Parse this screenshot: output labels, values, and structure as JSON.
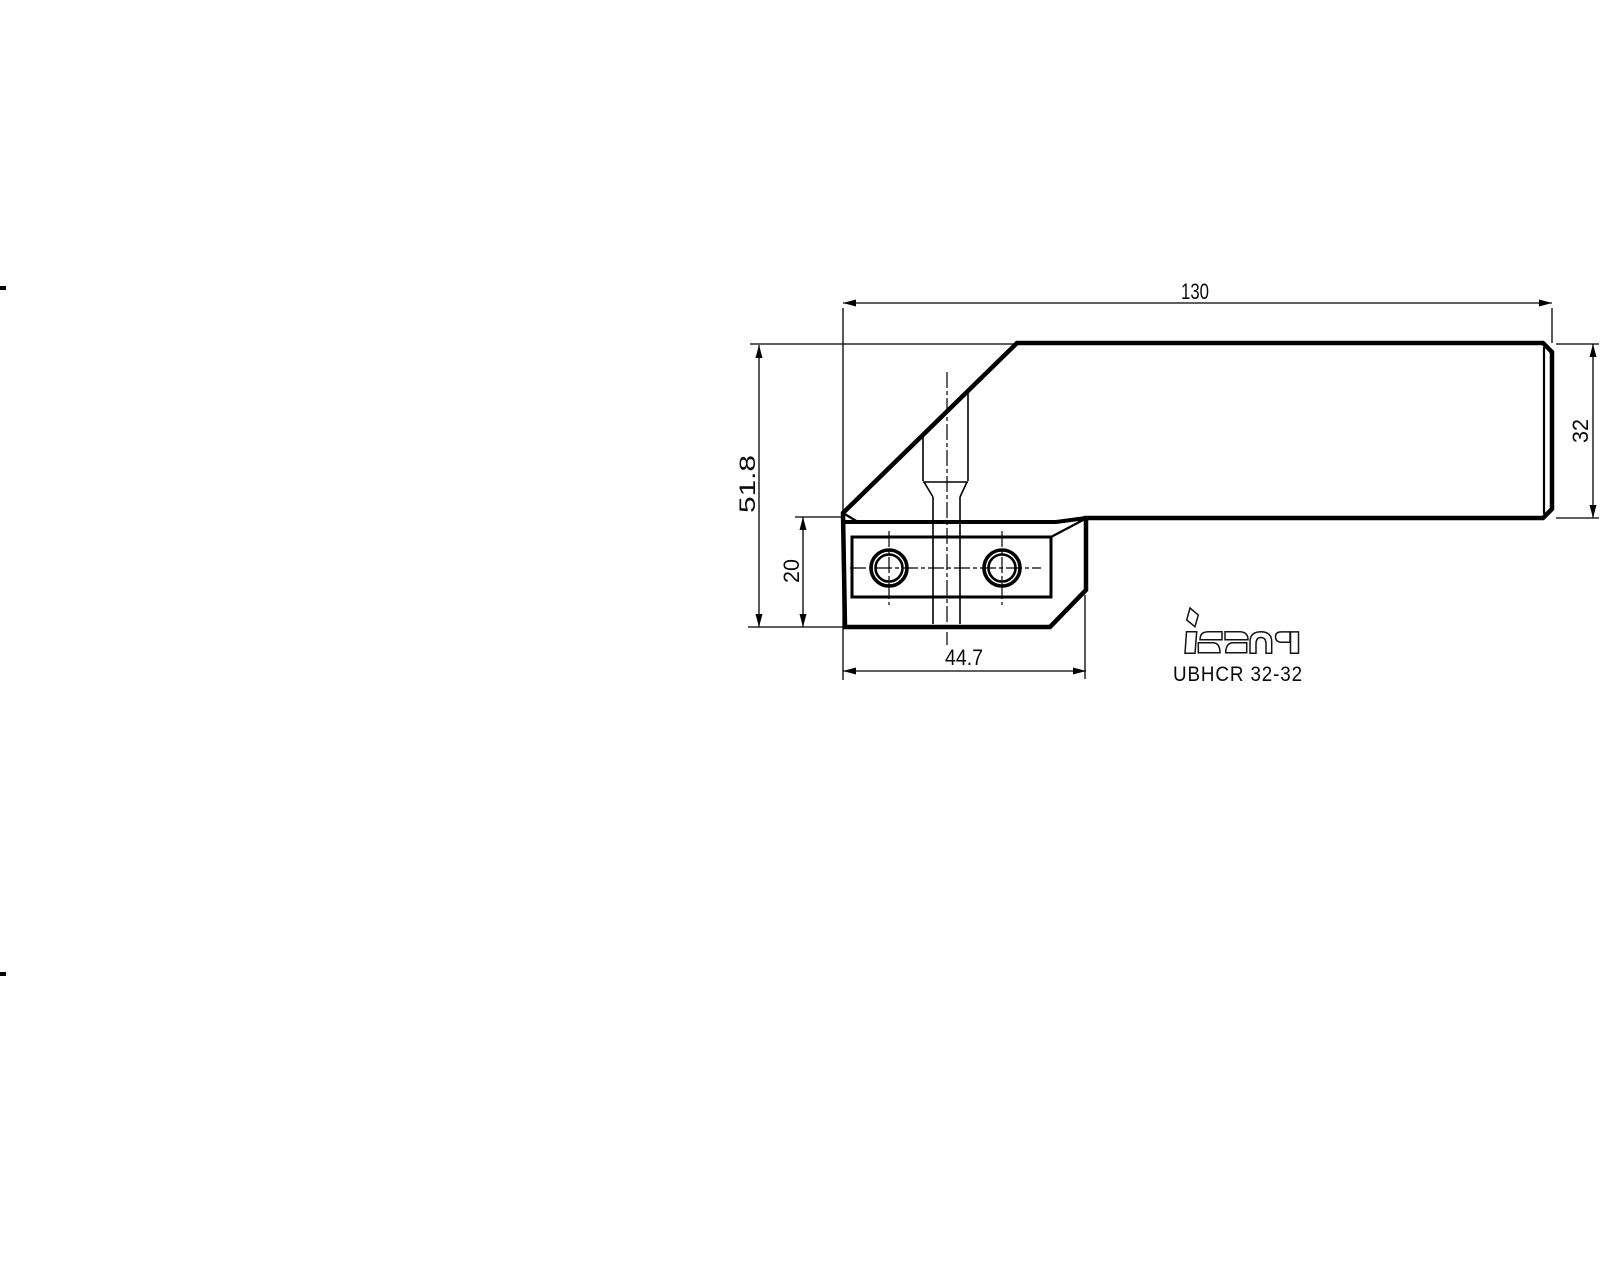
{
  "drawing": {
    "brand_logo": "iscar",
    "product_code": "UBHCR 32-32",
    "dimensions": {
      "overall_length": "130",
      "overall_height": "51.8",
      "head_height": "20",
      "head_length": "44.7",
      "shank_height": "32"
    },
    "line_color": "#000000",
    "background": "#ffffff"
  }
}
